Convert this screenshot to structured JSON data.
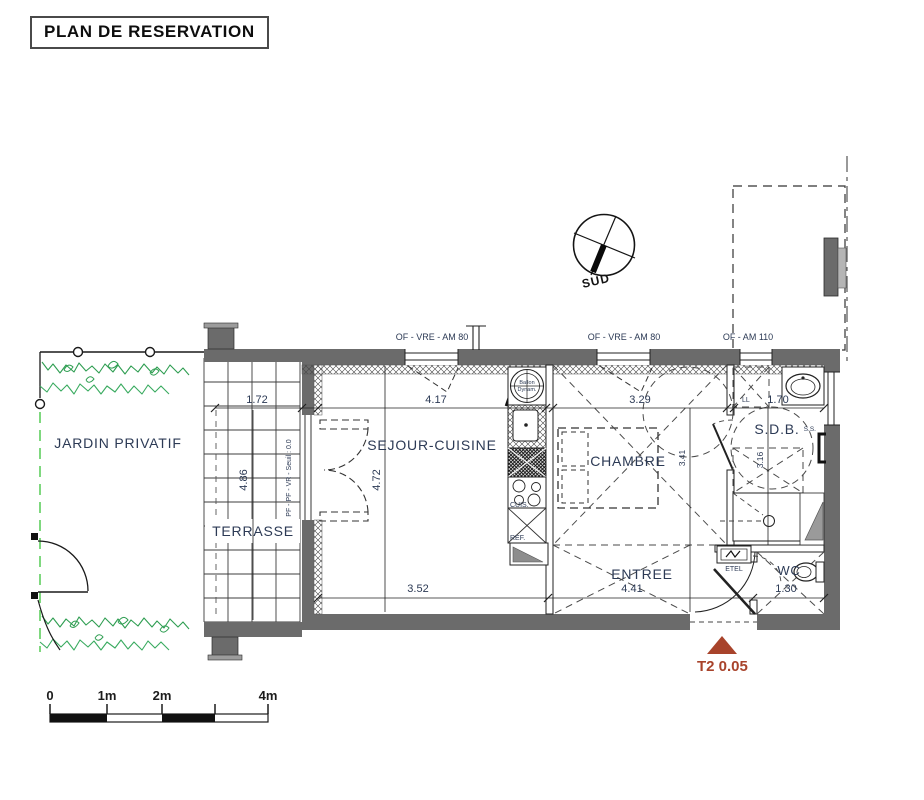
{
  "title": "PLAN DE RESERVATION",
  "compass": {
    "south_label": "SUD"
  },
  "window_labels": {
    "left": "OF - VRE - AM 80",
    "middle": "OF - VRE - AM 80",
    "right": "OF - AM 110"
  },
  "rooms": {
    "jardin": {
      "name": "JARDIN PRIVATIF"
    },
    "terrasse": {
      "name": "TERRASSE",
      "width": "1.72",
      "depth": "4.86",
      "threshold_note": "PF - PF - VR - Seuil : 0.0"
    },
    "sejour": {
      "name": "SEJOUR-CUISINE",
      "width": "4.17",
      "depth": "4.72",
      "width_bottom": "3.52"
    },
    "chambre": {
      "name": "CHAMBRE",
      "width": "3.29",
      "depth": "3.41"
    },
    "sdb": {
      "name": "S.D.B.",
      "width": "1.70",
      "depth": "3.16"
    },
    "entree": {
      "name": "ENTREE",
      "width": "4.41"
    },
    "wc": {
      "name": "WC",
      "width": "1.30"
    }
  },
  "equipment": {
    "kitchen_unit": "CUIS.",
    "fridge": "REF.",
    "water_heater_line1": "Ballon",
    "water_heater_line2": "Dynam.",
    "washing_machine": "LL",
    "towel_dryer": "S.S.",
    "electrical_panel": "ETEL"
  },
  "lot": {
    "label": "T2 0.05"
  },
  "scale_bar": {
    "t0": "0",
    "t1": "1m",
    "t2": "2m",
    "t4": "4m"
  },
  "colors": {
    "wall": "#6b6b6b",
    "label": "#2c3a55",
    "lot_marker": "#a8432b",
    "hedge_green": "#2f9e52",
    "boundary_green": "#7fd87f"
  }
}
